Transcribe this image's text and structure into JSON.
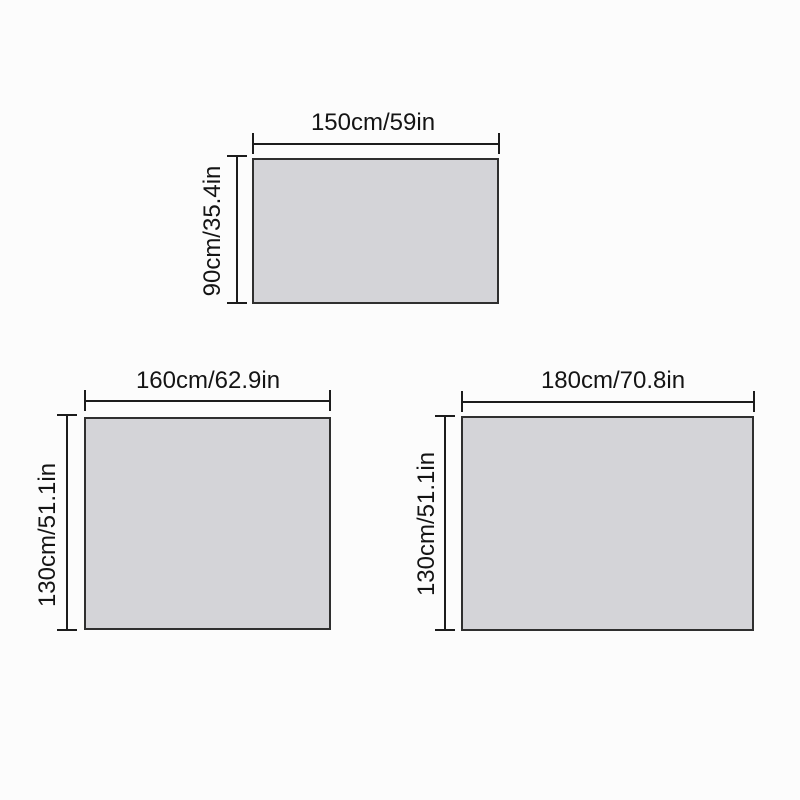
{
  "colors": {
    "background": "#fcfcfc",
    "panel_fill": "#d4d4d8",
    "panel_border": "#2f2f2f",
    "dimension_line": "#1c1c1c",
    "label_text": "#141414"
  },
  "diagrams": [
    {
      "position": "top",
      "width_label": "150cm/59in",
      "height_label": "90cm/35.4in"
    },
    {
      "position": "bottom-left",
      "width_label": "160cm/62.9in",
      "height_label": "130cm/51.1in"
    },
    {
      "position": "bottom-right",
      "width_label": "180cm/70.8in",
      "height_label": "130cm/51.1in"
    }
  ]
}
